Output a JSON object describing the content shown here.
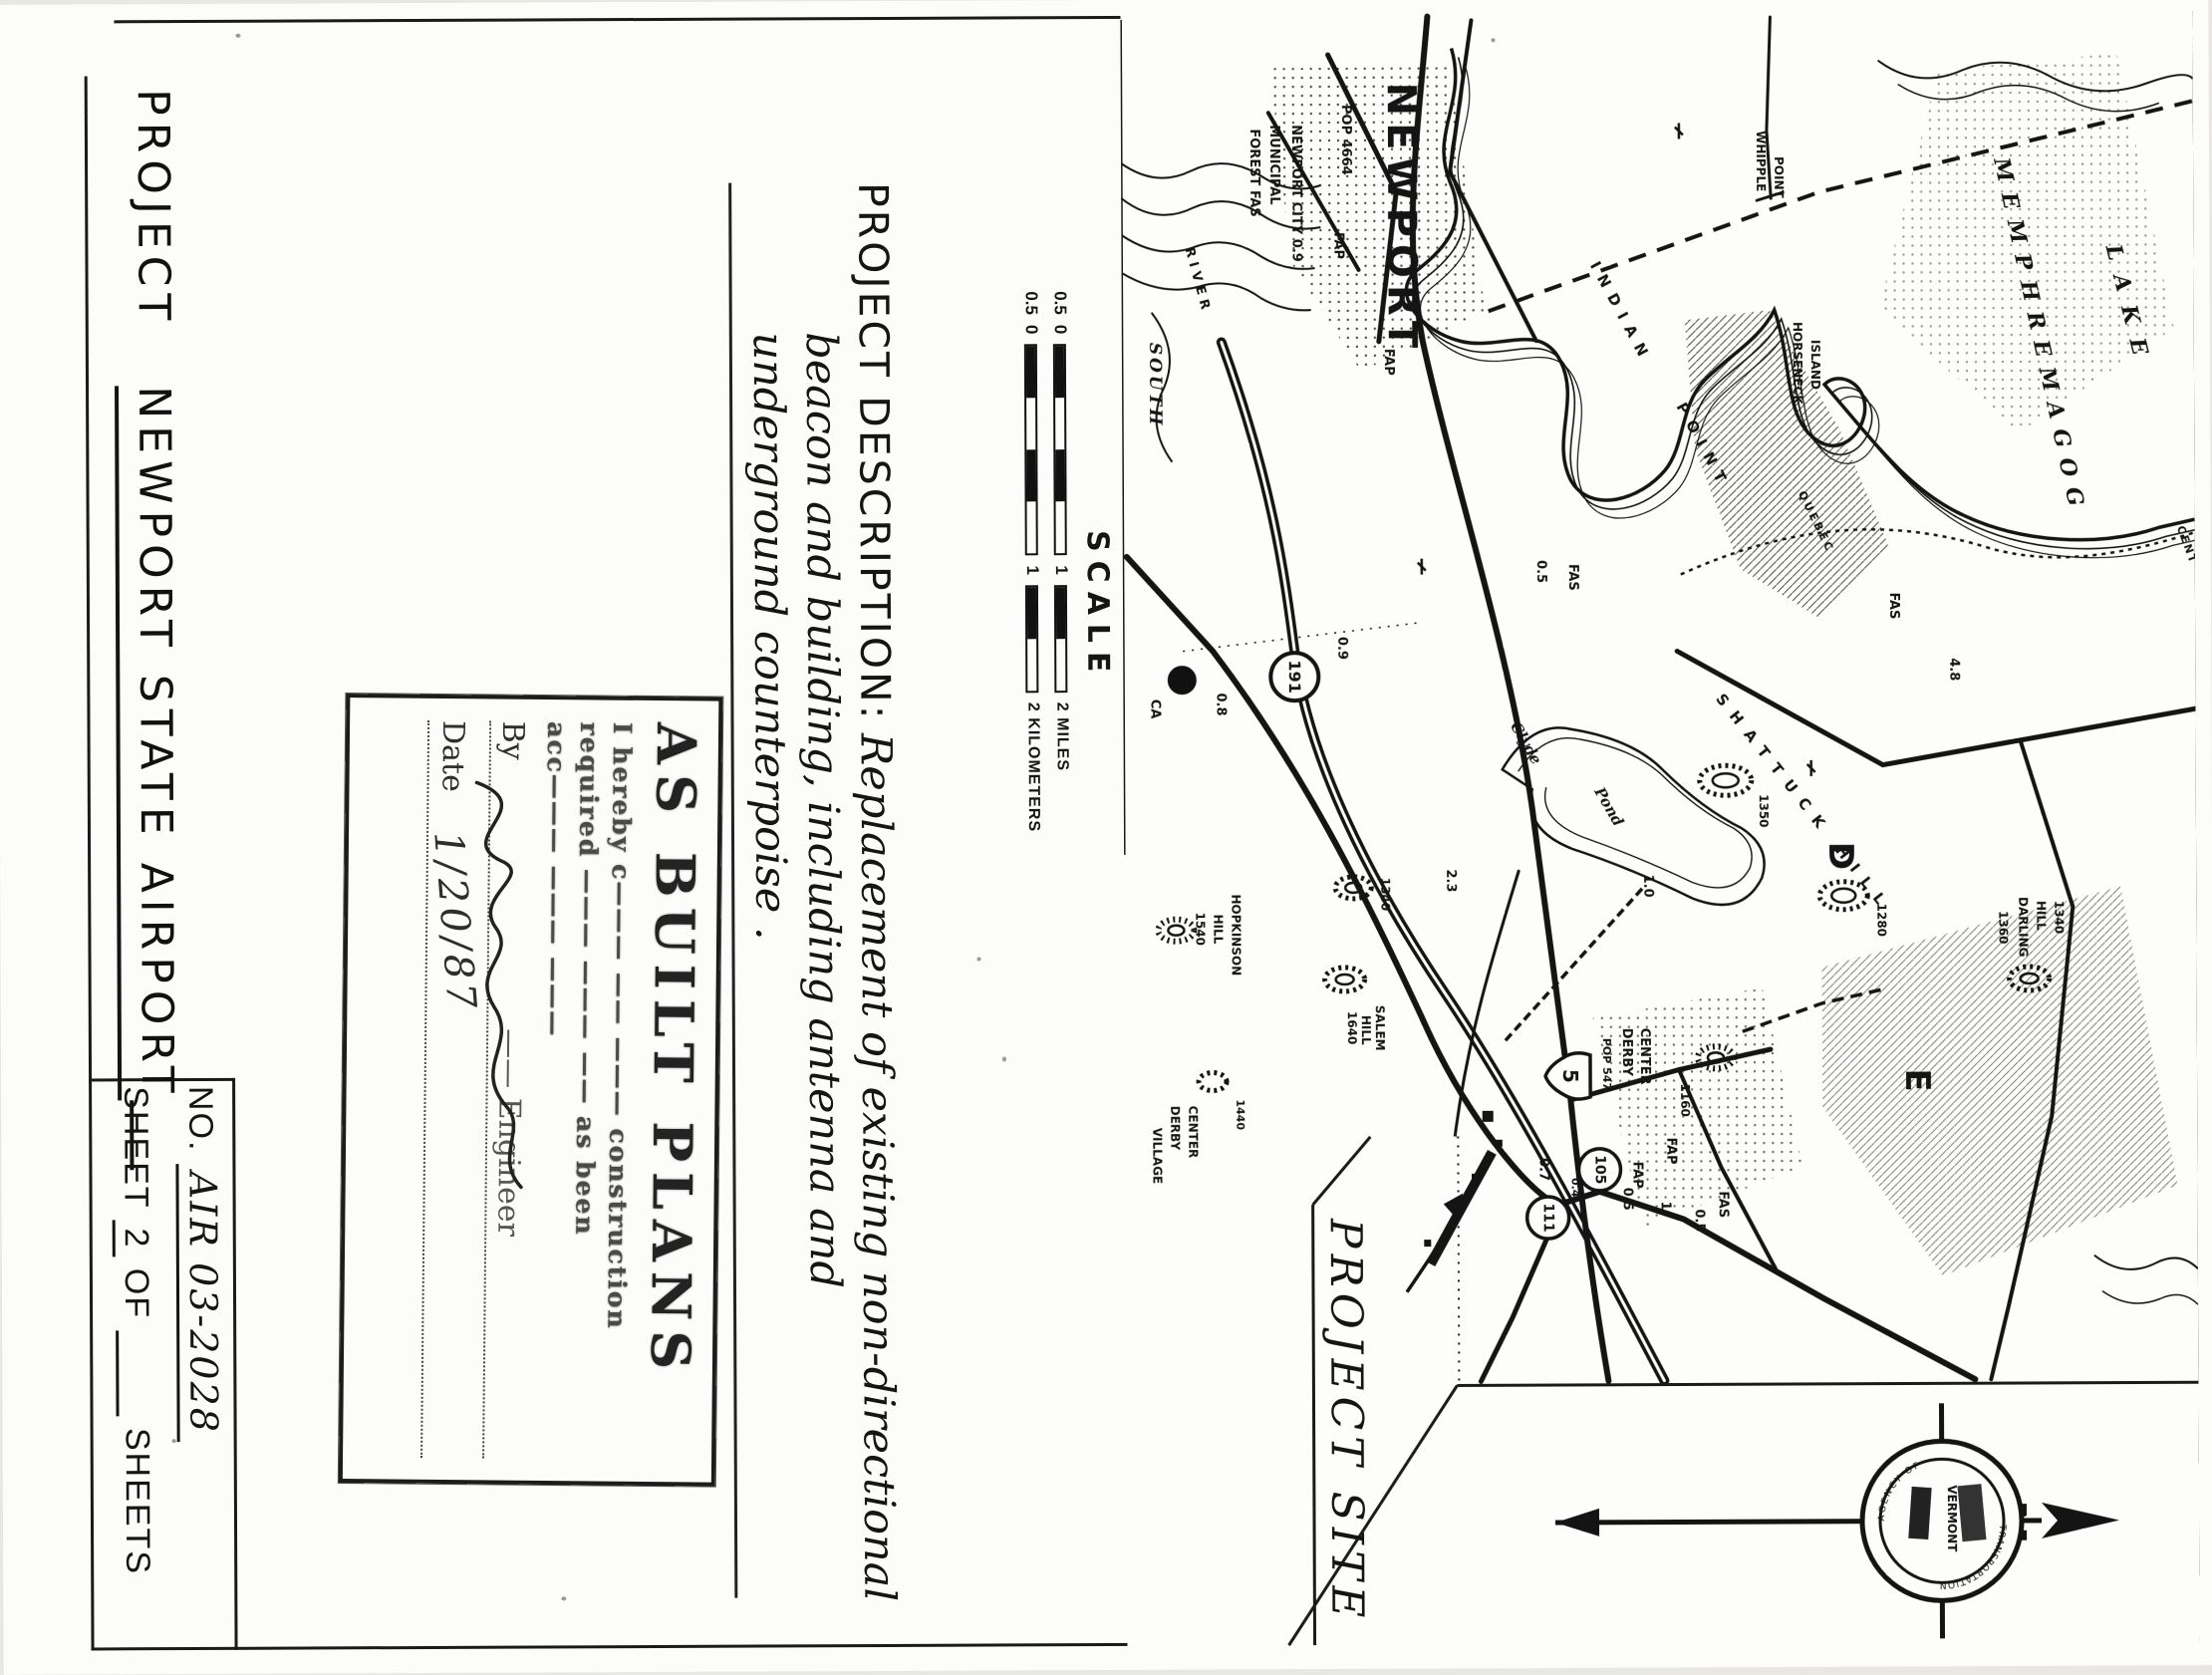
{
  "sheet": {
    "project_label": "PROJECT",
    "title": "NEWPORT STATE AIRPORT",
    "no_label": "NO.",
    "no_value": "AIR 03-2028",
    "sheet_label": "SHEET",
    "sheet_num": "2",
    "of_label": "OF",
    "sheets_label": "SHEETS"
  },
  "description": {
    "label": "PROJECT DESCRIPTION:",
    "line1": "Replacement of existing  non-directional",
    "line2": "beacon and building, including antenna and",
    "line3": "underground counterpoise ."
  },
  "stamp": {
    "heading": "AS BUILT PLANS",
    "line1": "I hereby c——— —— ——— construction",
    "line2": "required ——— ——— —— as been",
    "line3": "acc——— ——— ———",
    "by_label": "By",
    "engineer_label": "—— Engineer",
    "date_label": "Date",
    "date_value": "1/20/87"
  },
  "scale": {
    "label": "SCALE",
    "rows": [
      {
        "left": "0.5",
        "zero": "0",
        "mid": "1",
        "end": "2 MILES"
      },
      {
        "left": "0.5",
        "zero": "0",
        "mid": "1",
        "end": "2 KILOMETERS"
      }
    ]
  },
  "map": {
    "project_site": "PROJECT SITE",
    "labels": [
      {
        "text": "NEWPORT"
      },
      {
        "text": "POP 4664"
      },
      {
        "text": "FAP"
      },
      {
        "text": "NEWPORT CITY 0.9"
      },
      {
        "text": "MUNICIPAL"
      },
      {
        "text": "FOREST FAS"
      },
      {
        "text": "SOUTH"
      },
      {
        "text": "RIVER"
      },
      {
        "text": "INDIAN"
      },
      {
        "text": "POINT"
      },
      {
        "text": "WHIPPLE"
      },
      {
        "text": "POINT"
      },
      {
        "text": "HORSENECK"
      },
      {
        "text": "ISLAND"
      },
      {
        "text": "LAKE"
      },
      {
        "text": "MEMPHREMAGOG"
      },
      {
        "text": "QUEBEC"
      },
      {
        "text": "CENT"
      },
      {
        "text": "FAS"
      },
      {
        "text": "4.8"
      },
      {
        "text": "SHATTUCK HILL"
      },
      {
        "text": "1350"
      },
      {
        "text": "1280"
      },
      {
        "text": "D"
      },
      {
        "text": "E"
      },
      {
        "text": "1360"
      },
      {
        "text": "DARLING"
      },
      {
        "text": "HILL"
      },
      {
        "text": "1340"
      },
      {
        "text": "191"
      },
      {
        "text": "0.9"
      },
      {
        "text": "CA"
      },
      {
        "text": "0.8"
      },
      {
        "text": "Clyde"
      },
      {
        "text": "Pond"
      },
      {
        "text": "2.3"
      },
      {
        "text": "HOPKINSON"
      },
      {
        "text": "HILL"
      },
      {
        "text": "1540"
      },
      {
        "text": "1340"
      },
      {
        "text": "SALEM"
      },
      {
        "text": "HILL"
      },
      {
        "text": "1640"
      },
      {
        "text": "DERBY"
      },
      {
        "text": "CENTER"
      },
      {
        "text": "POP 547"
      },
      {
        "text": "1160"
      },
      {
        "text": "5"
      },
      {
        "text": "FAP"
      },
      {
        "text": "FAP"
      },
      {
        "text": "105"
      },
      {
        "text": "111"
      },
      {
        "text": "0.7"
      },
      {
        "text": "0.4"
      },
      {
        "text": "0.5"
      },
      {
        "text": "1"
      },
      {
        "text": "0.5"
      },
      {
        "text": "FAS"
      },
      {
        "text": "DERBY"
      },
      {
        "text": "CENTER"
      },
      {
        "text": "VILLAGE"
      },
      {
        "text": "1440"
      },
      {
        "text": "1.0"
      },
      {
        "text": "0.5"
      },
      {
        "text": "FAS"
      },
      {
        "text": "FAP"
      }
    ]
  },
  "compass": {
    "n": "N",
    "seal_center": "VERMONT",
    "seal_arc_top": "AGENCY OF",
    "seal_arc_bottom": "TRANSPORTATION"
  }
}
